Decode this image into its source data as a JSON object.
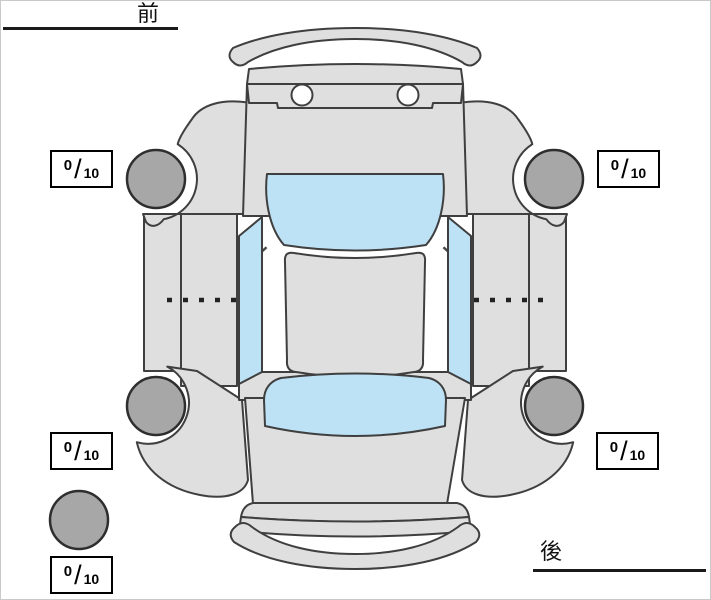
{
  "header": {
    "front_label": "前",
    "rear_label": "後"
  },
  "tire_scores": {
    "separator": "/",
    "front_left": {
      "value": "0",
      "max": "10"
    },
    "front_right": {
      "value": "0",
      "max": "10"
    },
    "rear_left": {
      "value": "0",
      "max": "10"
    },
    "rear_right": {
      "value": "0",
      "max": "10"
    },
    "spare": {
      "value": "0",
      "max": "10"
    }
  },
  "diagram": {
    "description": "car top view tire condition diagram",
    "colors": {
      "body": "#dfdfdf",
      "glass": "#bde1f5",
      "tire": "#a7a7a7",
      "outline": "#3f3f3f",
      "box_border": "#000000"
    }
  }
}
